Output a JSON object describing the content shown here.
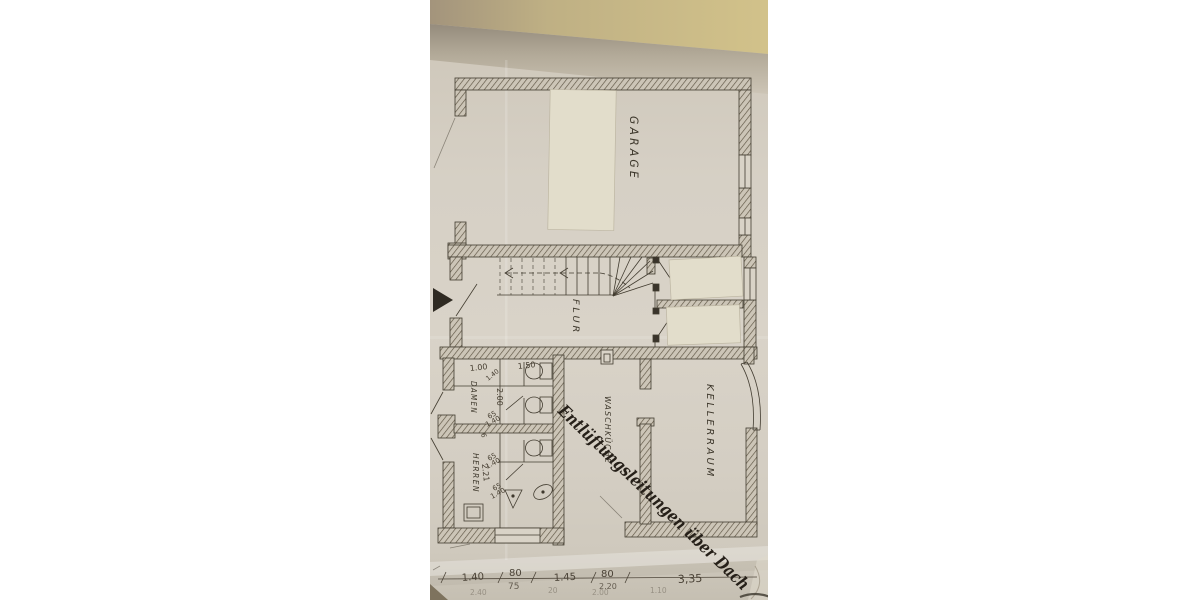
{
  "photo": {
    "rooms": {
      "garage": "GARAGE",
      "flur": "FLUR",
      "waschkueche": "WASCHKÜCHE",
      "kellerraum": "KELLERRAUM",
      "damen": "DAMEN",
      "herren": "HERREN"
    },
    "annotation": "Entlüftungsleitungen über Dach",
    "dims": {
      "toilets": {
        "w100": "1.00",
        "w150": "1.50",
        "w140": "1.40",
        "h200": "2.00",
        "s65a": "65",
        "s140a": "1.40",
        "n6": "6",
        "s65b": "65",
        "s140b": "1.40",
        "h221": "2.21",
        "s65c": "65",
        "s140c": "1.40"
      },
      "bottom": {
        "c140": "1.40",
        "c80a": "80",
        "c75": "75",
        "c145": "1.45",
        "c80b": "80",
        "c220": "2.20",
        "c335": "3,35"
      },
      "bottom_faint": {
        "f240": "2.40",
        "f20": "20",
        "f200": "2.00",
        "f110": "1.10"
      }
    },
    "colors": {
      "table": "#c4b382",
      "paper": "#d6d0c5",
      "ink": "#423c30",
      "pencil": "#4a4236",
      "handwriting": "#262019",
      "patch": "#e2ddcb"
    }
  }
}
